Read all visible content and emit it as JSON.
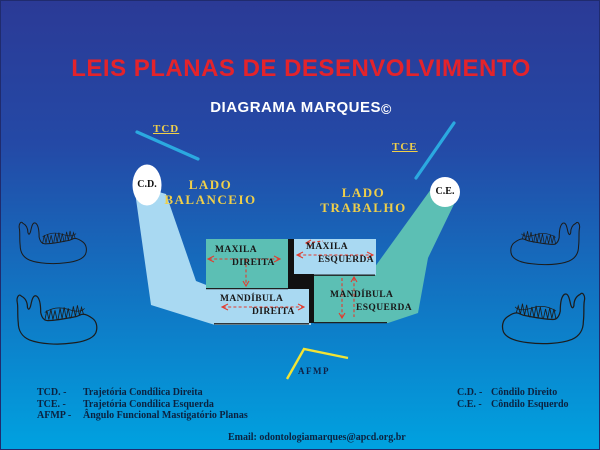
{
  "colors": {
    "background_top": "#2b3a96",
    "background_bottom": "#00a2e0",
    "title_red": "#e4232b",
    "subtitle_white": "#ffffff",
    "label_yellow": "#efcf4a",
    "afmp_yellow": "#f2e435",
    "trajectory_cyan": "#2ba9e0",
    "balance_band_blue": "#a9d9f2",
    "working_band_teal": "#5cbfb4",
    "divider_black": "#111111",
    "arrow_red": "#e23b2e",
    "legend_navy": "#0b2240",
    "box_text_dark": "#191919"
  },
  "header": {
    "title": "LEIS PLANAS DE DESENVOLVIMENTO",
    "subtitle": "DIAGRAMA MARQUES",
    "copyright": "©"
  },
  "diagram": {
    "tcd": "TCD",
    "tce": "TCE",
    "cd": "C.D.",
    "ce": "C.E.",
    "afmp": "AFMP",
    "lado_balanceio": {
      "line1": "LADO",
      "line2": "BALANCEIO"
    },
    "lado_trabalho": {
      "line1": "LADO",
      "line2": "TRABALHO"
    },
    "boxes": {
      "maxila_direita": {
        "line1": "MAXILA",
        "line2": "DIREITA"
      },
      "maxila_esquerda": {
        "line1": "MAXILA",
        "line2": "ESQUERDA"
      },
      "mandibula_direita": {
        "line1": "MANDÍBULA",
        "line2": "DIREITA"
      },
      "mandibula_esquerda": {
        "line1": "MANDÍBULA",
        "line2": "ESQUERDA"
      }
    }
  },
  "legend": {
    "left": [
      {
        "abbr": "TCD. -",
        "desc": "Trajetória Condílica Direita"
      },
      {
        "abbr": "TCE. -",
        "desc": "Trajetória Condílica Esquerda"
      },
      {
        "abbr": "AFMP -",
        "desc": "Ângulo Funcional Mastigatório Planas"
      }
    ],
    "right": [
      {
        "abbr": "C.D. -",
        "desc": "Côndilo Direito"
      },
      {
        "abbr": "C.E. -",
        "desc": "Côndilo Esquerdo"
      }
    ],
    "email": "Email: odontologiamarques@apcd.org.br"
  }
}
